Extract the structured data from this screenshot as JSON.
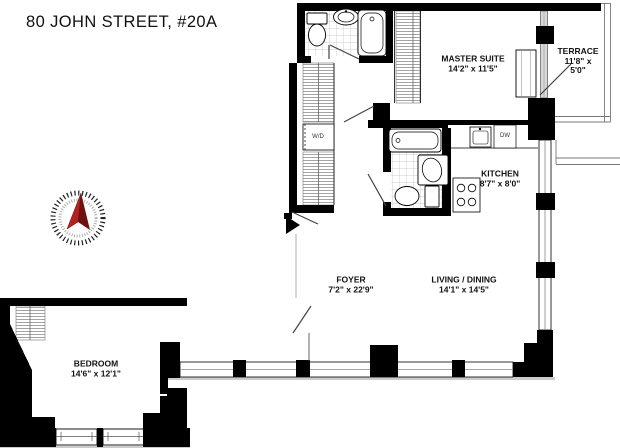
{
  "title": "80 JOHN STREET, #20A",
  "rooms": {
    "master_suite": {
      "name": "MASTER SUITE",
      "dims": "14'2\" x 11'5\""
    },
    "terrace": {
      "name": "TERRACE",
      "dims_line1": "11'8\" x",
      "dims_line2": "5'0\""
    },
    "kitchen": {
      "name": "KITCHEN",
      "dims": "8'7\" x 8'0\""
    },
    "foyer": {
      "name": "FOYER",
      "dims": "7'2\" x 22'9\""
    },
    "living_dining": {
      "name": "LIVING / DINING",
      "dims": "14'1\" x 14'5\""
    },
    "bedroom": {
      "name": "BEDROOM",
      "dims": "14'6\" x 12'1\""
    }
  },
  "appliances": {
    "washer_dryer": "W/D",
    "dishwasher": "DW"
  },
  "colors": {
    "wall": "#000000",
    "window_gray": "#c8c8c8",
    "hatch": "#9a9a9a",
    "tile": "#bdbdbd",
    "compass_red": "#b22222",
    "compass_red_dark": "#6e1010"
  }
}
